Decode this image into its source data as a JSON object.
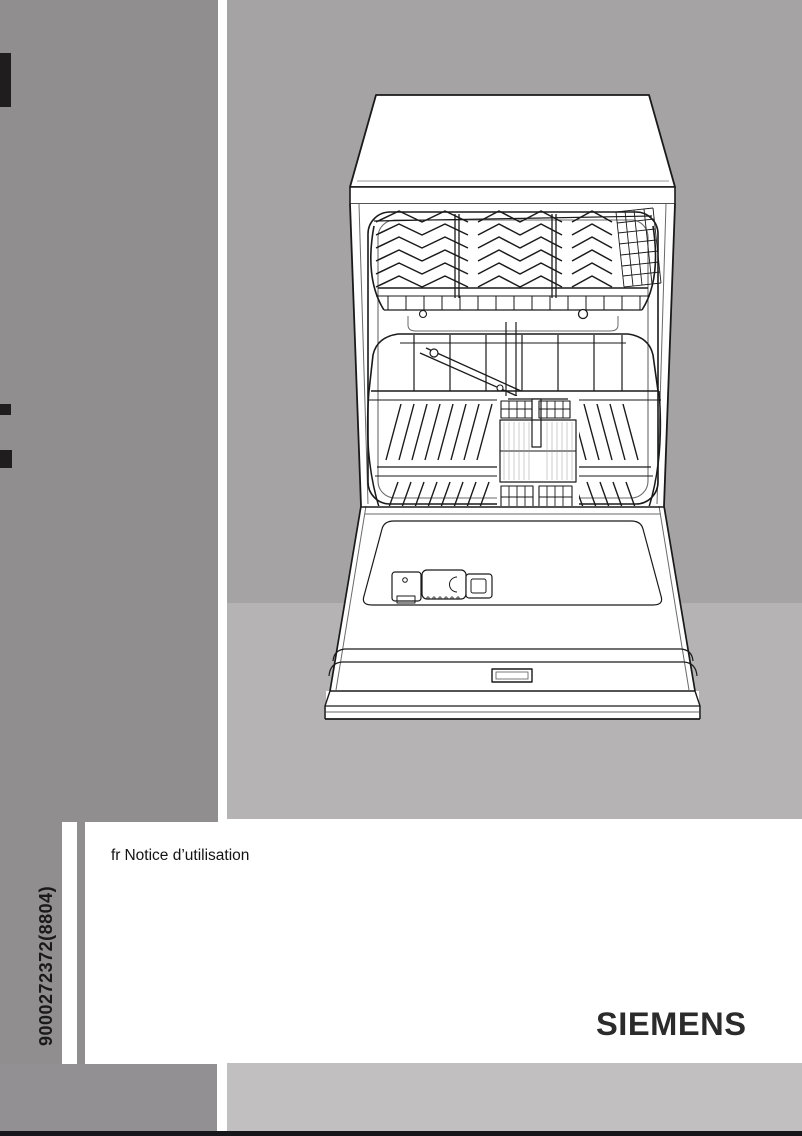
{
  "page": {
    "kind": "appliance-manual-cover",
    "vertical_doc_code": "9000272372(8804)",
    "notice": {
      "lang": "fr",
      "title": "Notice d’utilisation"
    },
    "brand": "SIEMENS"
  },
  "illustration": {
    "name": "dishwasher-open-front-line-art"
  },
  "colors": {
    "sidebar_gray": "#908e8f",
    "canvas_gray": "#a5a3a4",
    "floor_gray": "#b5b3b4",
    "footer_left_gray": "#929092",
    "footer_right_gray": "#c1bfc0",
    "bottom_bar_black": "#17171b",
    "bleed_tab_black": "#1f1d1e",
    "line_art_ink": "#1a1a1a",
    "text_black": "#1a1a1a"
  }
}
